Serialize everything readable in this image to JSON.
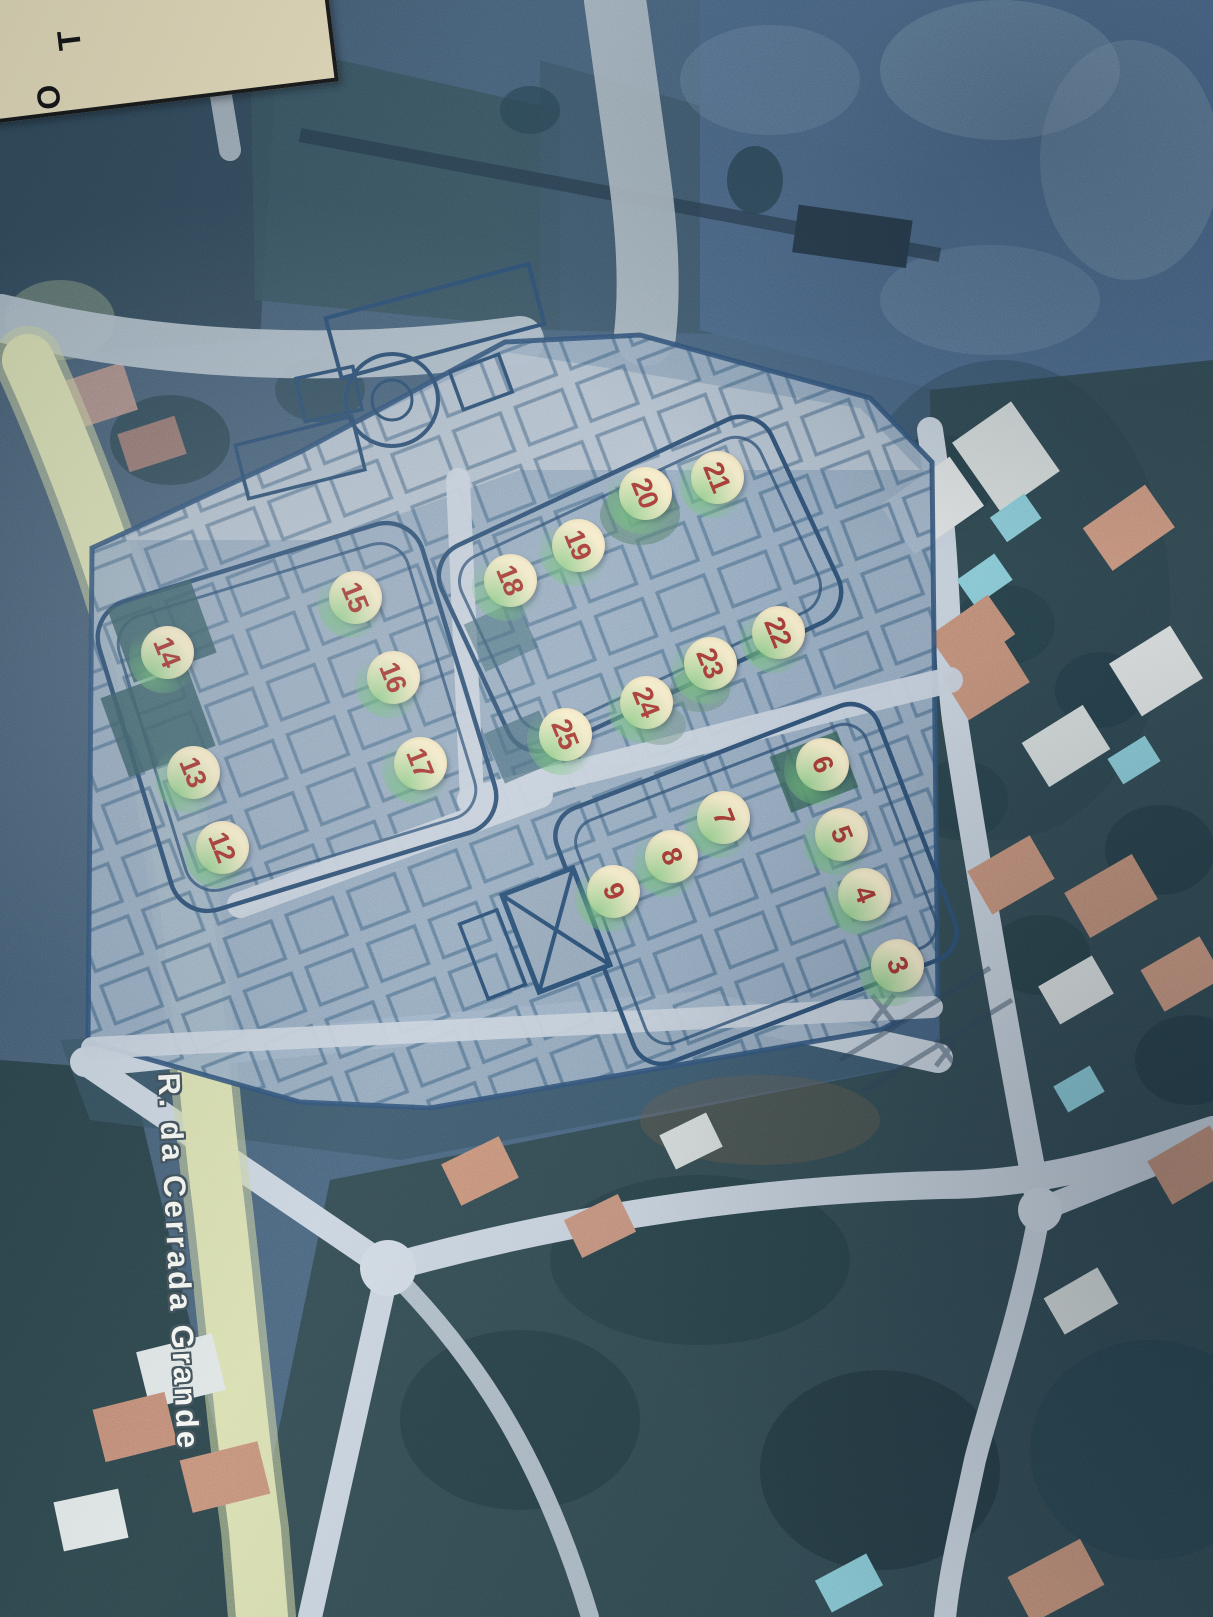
{
  "map": {
    "street_label": "R. da Cerrada Grande",
    "corner_label": {
      "t": "T",
      "o": "O"
    },
    "colors": {
      "marker_fill": "#f6ecca",
      "marker_number": "#a8352f",
      "marker_glow": "#6fc277",
      "plan_line": "#27496d",
      "road_yellow": "#d6dcab",
      "road_gray": "#c6d1dc"
    },
    "lot_markers": [
      {
        "number": "21",
        "x": 717,
        "y": 477
      },
      {
        "number": "20",
        "x": 645,
        "y": 493
      },
      {
        "number": "19",
        "x": 578,
        "y": 545
      },
      {
        "number": "18",
        "x": 510,
        "y": 580
      },
      {
        "number": "15",
        "x": 355,
        "y": 597
      },
      {
        "number": "22",
        "x": 778,
        "y": 632
      },
      {
        "number": "14",
        "x": 167,
        "y": 652
      },
      {
        "number": "23",
        "x": 710,
        "y": 663
      },
      {
        "number": "16",
        "x": 393,
        "y": 677
      },
      {
        "number": "24",
        "x": 646,
        "y": 702
      },
      {
        "number": "25",
        "x": 565,
        "y": 734
      },
      {
        "number": "6",
        "x": 822,
        "y": 764
      },
      {
        "number": "17",
        "x": 420,
        "y": 763
      },
      {
        "number": "13",
        "x": 193,
        "y": 772
      },
      {
        "number": "7",
        "x": 723,
        "y": 817
      },
      {
        "number": "5",
        "x": 841,
        "y": 834
      },
      {
        "number": "12",
        "x": 222,
        "y": 847
      },
      {
        "number": "8",
        "x": 671,
        "y": 856
      },
      {
        "number": "9",
        "x": 613,
        "y": 891
      },
      {
        "number": "4",
        "x": 864,
        "y": 894
      },
      {
        "number": "3",
        "x": 897,
        "y": 965
      }
    ]
  }
}
